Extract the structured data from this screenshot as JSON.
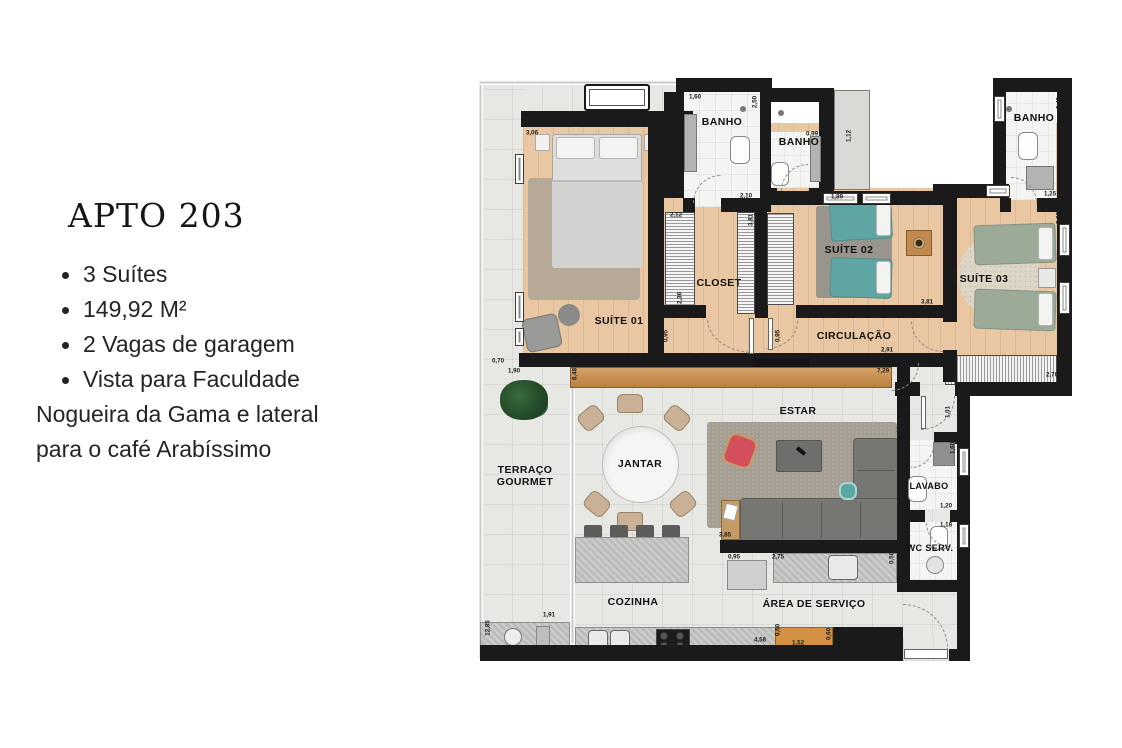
{
  "panel": {
    "title": "APTO 203",
    "bullets": [
      "3 Suítes",
      "149,92 M²",
      "2 Vagas de garagem",
      "Vista para Faculdade Nogueira da Gama e lateral para o café Arabíssimo"
    ]
  },
  "floorplan": {
    "rooms": [
      {
        "label": "BANHO",
        "x": 244,
        "y": 44
      },
      {
        "label": "BANHO",
        "x": 321,
        "y": 64
      },
      {
        "label": "BANHO",
        "x": 556,
        "y": 40
      },
      {
        "label": "SUÍTE 01",
        "x": 141,
        "y": 243
      },
      {
        "label": "CLOSET",
        "x": 241,
        "y": 205
      },
      {
        "label": "SUÍTE 02",
        "x": 371,
        "y": 172
      },
      {
        "label": "SUÍTE 03",
        "x": 506,
        "y": 201
      },
      {
        "label": "CIRCULAÇÃO",
        "x": 376,
        "y": 258
      },
      {
        "label": "ESTAR",
        "x": 320,
        "y": 333
      },
      {
        "label": "JANTAR",
        "x": 162,
        "y": 386
      },
      {
        "label": "TERRAÇO GOURMET",
        "x": 47,
        "y": 398,
        "w": 92
      },
      {
        "label": "LAVABO",
        "x": 451,
        "y": 408,
        "s": 9
      },
      {
        "label": "WC SERV.",
        "x": 452,
        "y": 470,
        "s": 9
      },
      {
        "label": "COZINHA",
        "x": 155,
        "y": 524
      },
      {
        "label": "ÁREA DE SERVIÇO",
        "x": 336,
        "y": 526
      }
    ],
    "dimensions": [
      {
        "t": "3,06",
        "x": 54,
        "y": 55
      },
      {
        "t": "0,50",
        "x": 195,
        "y": 60
      },
      {
        "t": "1,60",
        "x": 195,
        "y": 110,
        "v": 1
      },
      {
        "t": "1,60",
        "x": 217,
        "y": 19
      },
      {
        "t": "2,50",
        "x": 277,
        "y": 24,
        "v": 1
      },
      {
        "t": "0,90",
        "x": 298,
        "y": 19
      },
      {
        "t": "0,99",
        "x": 334,
        "y": 56
      },
      {
        "t": "2,35",
        "x": 288,
        "y": 98,
        "v": 1
      },
      {
        "t": "1,12",
        "x": 371,
        "y": 58,
        "v": 1
      },
      {
        "t": "2,12",
        "x": 198,
        "y": 137
      },
      {
        "t": "2,10",
        "x": 268,
        "y": 118
      },
      {
        "t": "2,40",
        "x": 581,
        "y": 25,
        "v": 1
      },
      {
        "t": "1,25",
        "x": 572,
        "y": 116
      },
      {
        "t": "3,93",
        "x": 581,
        "y": 140,
        "v": 1
      },
      {
        "t": "2,36",
        "x": 202,
        "y": 220,
        "v": 1
      },
      {
        "t": "3,81",
        "x": 273,
        "y": 142,
        "v": 1
      },
      {
        "t": "3,81",
        "x": 197,
        "y": 236
      },
      {
        "t": "0,95",
        "x": 188,
        "y": 258,
        "v": 1
      },
      {
        "t": "0,95",
        "x": 300,
        "y": 258,
        "v": 1
      },
      {
        "t": "1,89",
        "x": 359,
        "y": 119
      },
      {
        "t": "3,81",
        "x": 449,
        "y": 224
      },
      {
        "t": "2,91",
        "x": 409,
        "y": 272
      },
      {
        "t": "7,29",
        "x": 405,
        "y": 293
      },
      {
        "t": "6,48",
        "x": 97,
        "y": 296,
        "v": 1
      },
      {
        "t": "0,70",
        "x": 20,
        "y": 283
      },
      {
        "t": "1,90",
        "x": 36,
        "y": 293
      },
      {
        "t": "4,59",
        "x": 471,
        "y": 291,
        "v": 1
      },
      {
        "t": "2,70",
        "x": 574,
        "y": 297
      },
      {
        "t": "1,60",
        "x": 457,
        "y": 281,
        "v": 1
      },
      {
        "t": "1,51",
        "x": 424,
        "y": 352
      },
      {
        "t": "1,01",
        "x": 470,
        "y": 334,
        "v": 1
      },
      {
        "t": "1,60",
        "x": 475,
        "y": 370,
        "v": 1
      },
      {
        "t": "1,20",
        "x": 468,
        "y": 428
      },
      {
        "t": "1,18",
        "x": 468,
        "y": 447
      },
      {
        "t": "1,30",
        "x": 430,
        "y": 456,
        "v": 1
      },
      {
        "t": "3,85",
        "x": 247,
        "y": 457
      },
      {
        "t": "0,95",
        "x": 256,
        "y": 479
      },
      {
        "t": "2,75",
        "x": 300,
        "y": 479
      },
      {
        "t": "0,50",
        "x": 414,
        "y": 480,
        "v": 1
      },
      {
        "t": "4,58",
        "x": 282,
        "y": 562
      },
      {
        "t": "1,52",
        "x": 320,
        "y": 565
      },
      {
        "t": "0,60",
        "x": 351,
        "y": 556,
        "v": 1
      },
      {
        "t": "0,60",
        "x": 300,
        "y": 552,
        "v": 1
      },
      {
        "t": "1,91",
        "x": 71,
        "y": 537
      },
      {
        "t": "12,85",
        "x": 10,
        "y": 550,
        "v": 1
      }
    ]
  },
  "colors": {
    "wall": "#1a1a1a",
    "wood_floor": "#e8c7a2",
    "tile_floor": "#e7e7e4",
    "bath_floor": "#f4f4f2",
    "teal_bed": "#5fa5a3",
    "sage_bed": "#9cab98",
    "sofa_gray": "#767672",
    "accent_red": "#d44f5e",
    "sideboard_wood": "#c98c50",
    "cabinet_orange": "#d49045"
  }
}
